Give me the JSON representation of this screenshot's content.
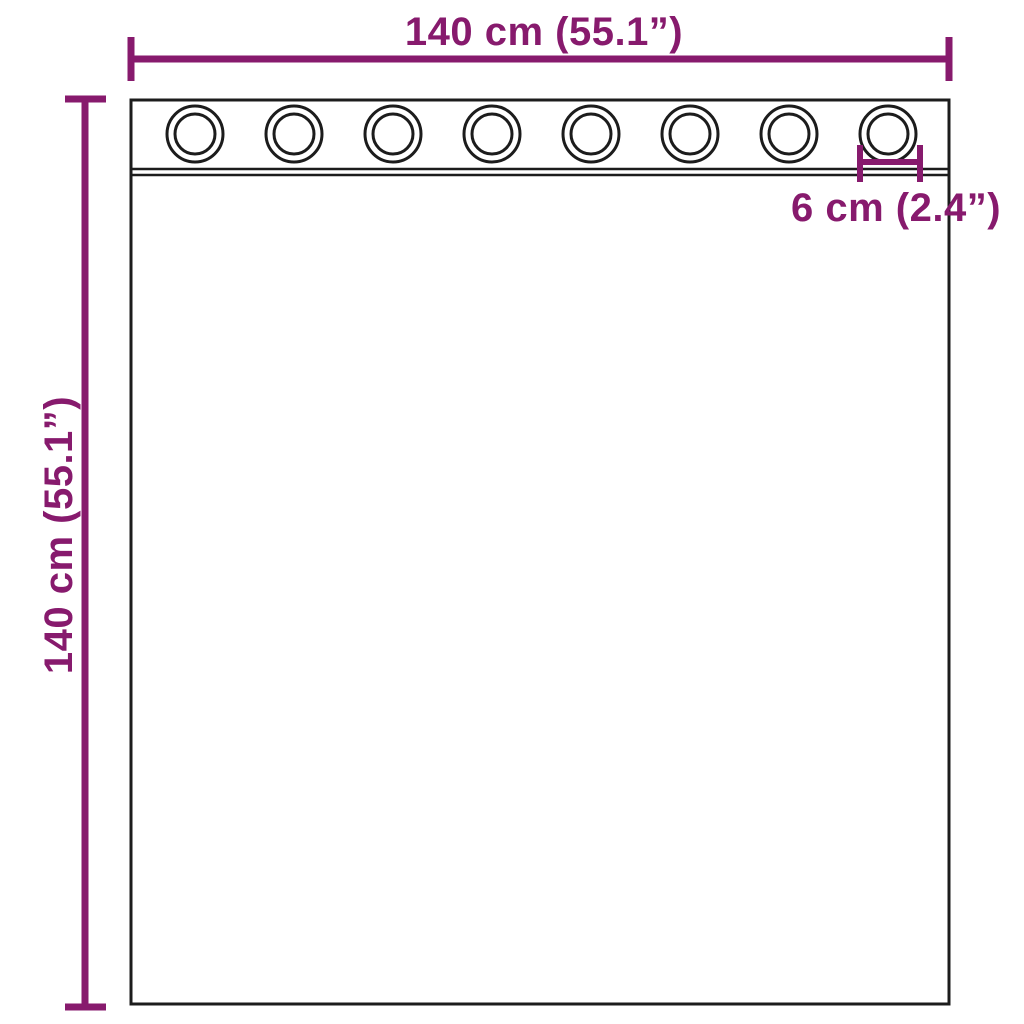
{
  "colors": {
    "dimension_accent": "#871a6d",
    "outline": "#1c1c1c",
    "background": "#ffffff"
  },
  "diagram": {
    "width_label": "140 cm (55.1”)",
    "height_label": "140 cm (55.1”)",
    "eyelet_spacing_label": "6 cm (2.4”)",
    "eyelet_count": 8
  }
}
